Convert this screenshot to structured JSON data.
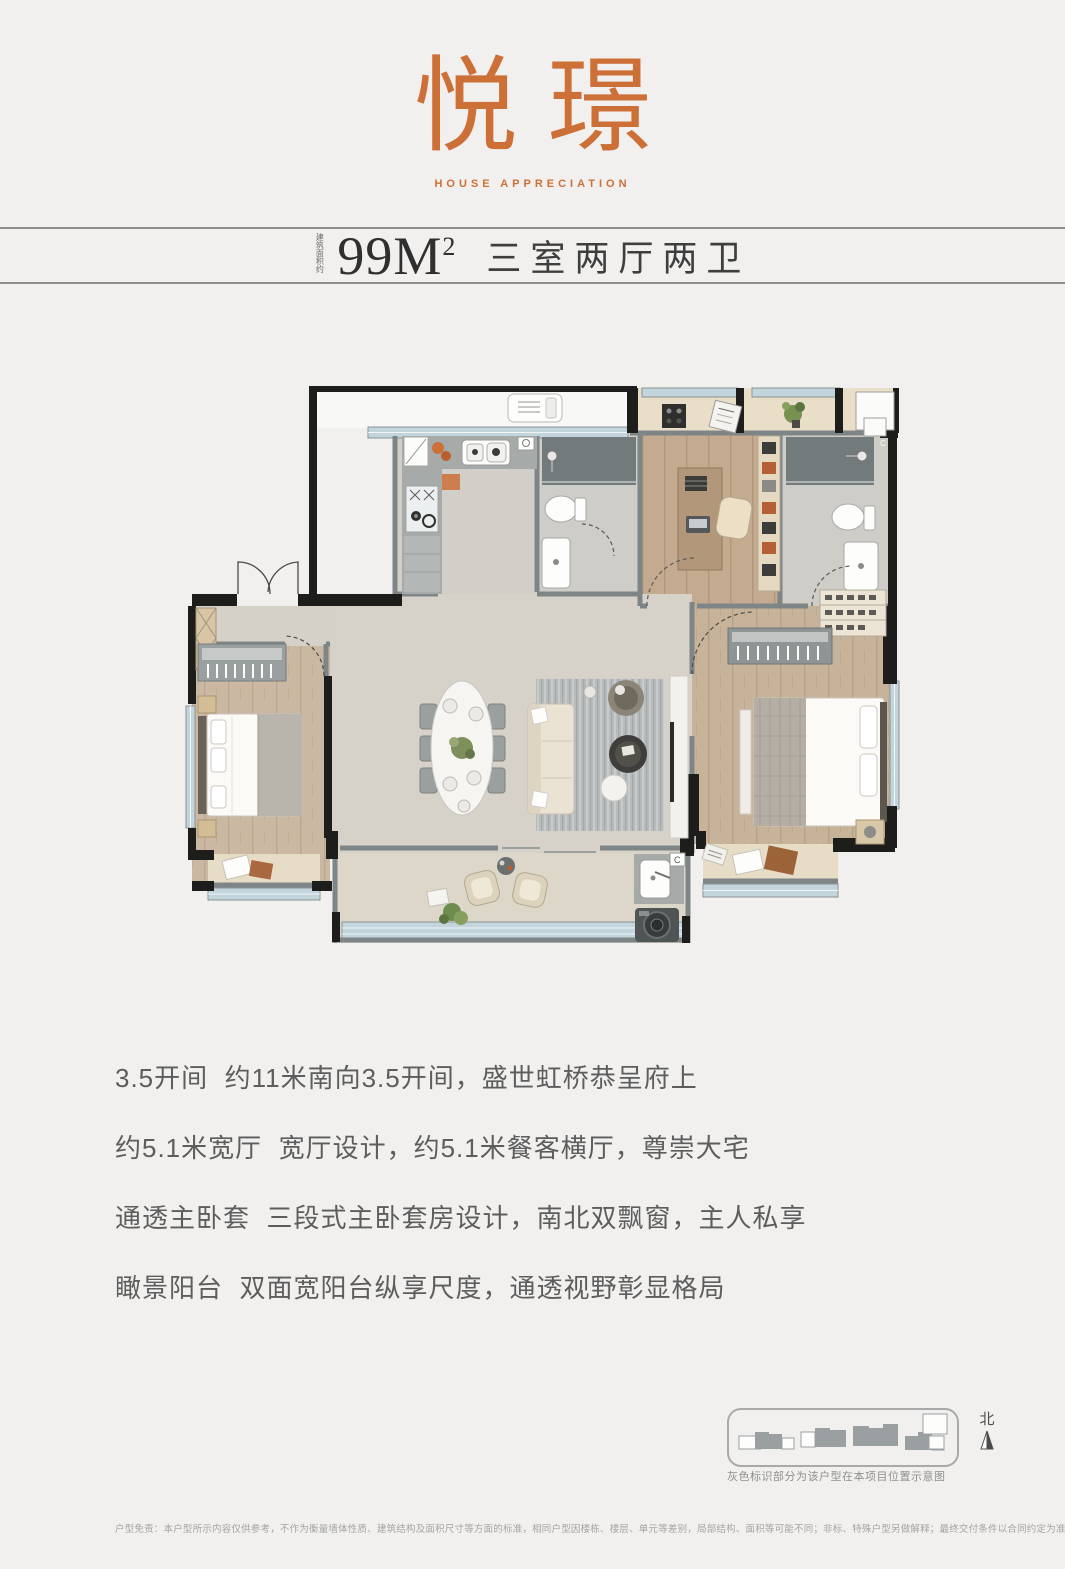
{
  "header": {
    "title": "悦璟",
    "subtitle": "HOUSE APPRECIATION"
  },
  "spec": {
    "area_prefix_vertical": "建筑面积约",
    "area": "99M",
    "area_sup": "2",
    "layout": "三室两厅两卫"
  },
  "features": [
    "3.5开间  约11米南向3.5开间，盛世虹桥恭呈府上",
    "约5.1米宽厅  宽厅设计，约5.1米餐客横厅，尊崇大宅",
    "通透主卧套  三段式主卧套房设计，南北双飘窗，主人私享",
    "瞰景阳台  双面宽阳台纵享尺度，通透视野彰显格局"
  ],
  "site": {
    "north_label": "北",
    "caption": "灰色标识部分为该户型在本项目位置示意图"
  },
  "disclaimer": "户型免责：本户型所示内容仅供参考，不作为衡量墙体性质、建筑结构及面积尺寸等方面的标准，相同户型因楼栋、楼层、单元等差别，局部结构、面积等可能不同；非标、特殊户型另做解释；最终交付条件以合同约定为准。",
  "colors": {
    "accent_orange": "#cd7038",
    "wall_black": "#1d1d1b",
    "partition_gray": "#7e8586",
    "tile_floor": "#d6d2c9",
    "wood_floor": "#cbb8a2",
    "window_blue": "#c3d5dc",
    "counter_gray": "#a6aba9",
    "shower_gray": "#737a7b"
  }
}
